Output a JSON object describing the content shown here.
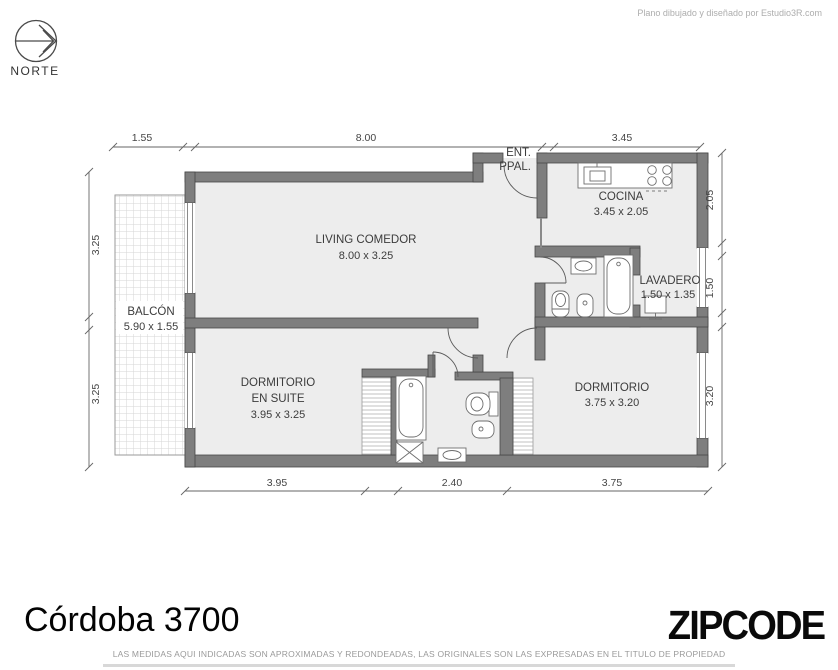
{
  "credit": "Plano dibujado y diseñado por Estudio3R.com",
  "north_label": "NORTE",
  "entrance": {
    "line1": "ENT.",
    "line2": "PPAL."
  },
  "rooms": {
    "living": {
      "name": "LIVING COMEDOR",
      "size": "8.00 x 3.25"
    },
    "cocina": {
      "name": "COCINA",
      "size": "3.45 x 2.05"
    },
    "lavadero": {
      "name": "LAVADERO",
      "size": "1.50 x 1.35"
    },
    "balcon": {
      "name": "BALCÓN",
      "size": "5.90 x 1.55"
    },
    "suite": {
      "name1": "DORMITORIO",
      "name2": "EN SUITE",
      "size": "3.95 x 3.25"
    },
    "dormitorio": {
      "name": "DORMITORIO",
      "size": "3.75 x 3.20"
    }
  },
  "dimensions": {
    "top": [
      "1.55",
      "8.00",
      "3.45"
    ],
    "bottom": [
      "3.95",
      "2.40",
      "3.75"
    ],
    "left": [
      "3.25",
      "3.25"
    ],
    "right": [
      "2.05",
      "1.50",
      "3.20"
    ]
  },
  "footer": {
    "title": "Córdoba 3700",
    "logo": "ZIPCODE",
    "disclaimer": "LAS MEDIDAS AQUI INDICADAS SON APROXIMADAS Y REDONDEADAS, LAS ORIGINALES SON LAS EXPRESADAS EN EL TITULO DE PROPIEDAD"
  },
  "colors": {
    "wall": "#7e7e7e",
    "floor": "#ededed",
    "dim_text": "#454545",
    "muted": "#a8a8a8",
    "logo": "#0a0a0a"
  }
}
